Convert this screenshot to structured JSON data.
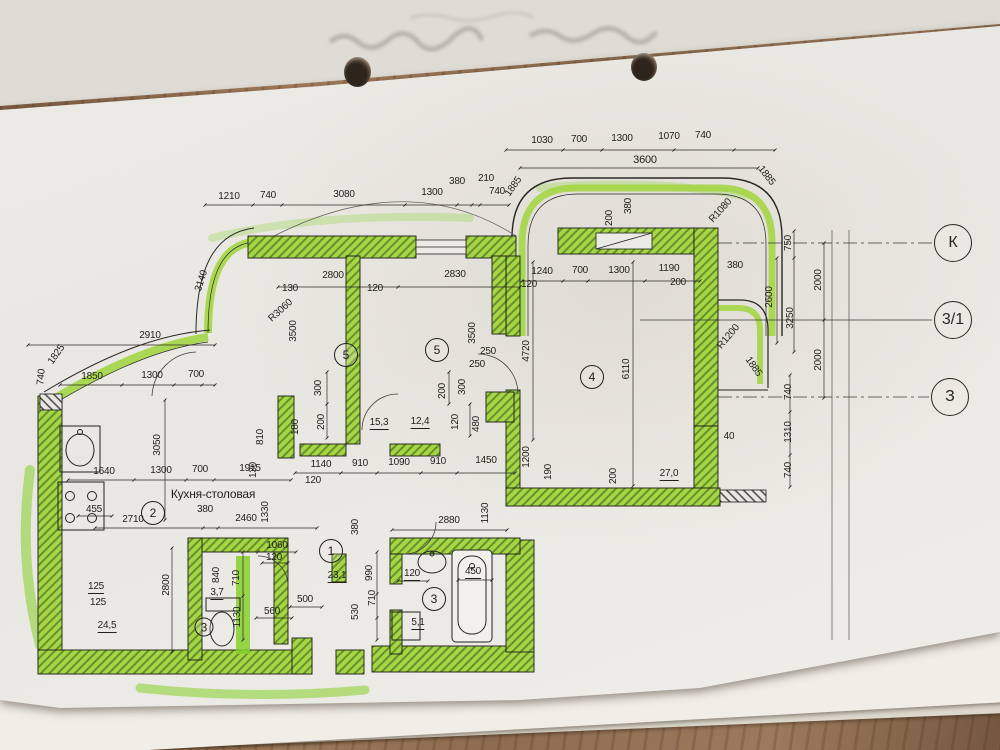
{
  "drawing": {
    "kind": "apartment floor plan, photographed sheet",
    "room_label_kitchen": "Кухня-столовая"
  },
  "colors": {
    "wall_highlight": "#a4d645",
    "marker_green": "#86cf2b",
    "paper": "#eae8e2",
    "ink": "#211f1b",
    "wood": "#8a6a4f"
  },
  "axis_markers": [
    {
      "t": "К",
      "x": 953,
      "y": 243
    },
    {
      "t": "3/1",
      "x": 953,
      "y": 320
    },
    {
      "t": "З",
      "x": 950,
      "y": 397
    }
  ],
  "room_markers": [
    {
      "n": "5",
      "x": 346,
      "y": 355,
      "d": 22
    },
    {
      "n": "5",
      "x": 437,
      "y": 350,
      "d": 22
    },
    {
      "n": "4",
      "x": 592,
      "y": 377,
      "d": 22
    },
    {
      "n": "1",
      "x": 331,
      "y": 551,
      "d": 22
    },
    {
      "n": "2",
      "x": 153,
      "y": 513,
      "d": 22
    },
    {
      "n": "3",
      "x": 434,
      "y": 599,
      "d": 22
    },
    {
      "n": "3",
      "x": 204,
      "y": 627,
      "d": 17
    }
  ],
  "rooms": [
    {
      "number": "5",
      "area": "15,3"
    },
    {
      "number": "5",
      "area": "12,4"
    },
    {
      "number": "4",
      "area": "27,0"
    },
    {
      "number": "1",
      "area": "23,1"
    },
    {
      "number": "2",
      "name": "Кухня-столовая",
      "area": "24,5"
    },
    {
      "number": "3",
      "area": "5,1"
    },
    {
      "number": "3",
      "area": "3,7"
    }
  ],
  "dimension_labels": [
    {
      "t": "1030",
      "x": 542,
      "y": 141
    },
    {
      "t": "700",
      "x": 579,
      "y": 140
    },
    {
      "t": "1300",
      "x": 622,
      "y": 139
    },
    {
      "t": "1070",
      "x": 669,
      "y": 137
    },
    {
      "t": "740",
      "x": 703,
      "y": 136
    },
    {
      "t": "3600",
      "x": 645,
      "y": 160,
      "s": 11
    },
    {
      "t": "1885",
      "x": 514,
      "y": 187,
      "r": -55
    },
    {
      "t": "1885",
      "x": 766,
      "y": 176,
      "r": 52
    },
    {
      "t": "R1080",
      "x": 721,
      "y": 211,
      "r": -48
    },
    {
      "t": "200",
      "x": 610,
      "y": 218,
      "r": -90
    },
    {
      "t": "380",
      "x": 629,
      "y": 206,
      "r": -90
    },
    {
      "t": "1210",
      "x": 229,
      "y": 197
    },
    {
      "t": "740",
      "x": 268,
      "y": 196
    },
    {
      "t": "3080",
      "x": 344,
      "y": 195
    },
    {
      "t": "1300",
      "x": 432,
      "y": 193
    },
    {
      "t": "380",
      "x": 457,
      "y": 182
    },
    {
      "t": "210",
      "x": 486,
      "y": 179
    },
    {
      "t": "740",
      "x": 497,
      "y": 192
    },
    {
      "t": "3140",
      "x": 202,
      "y": 281,
      "r": -72
    },
    {
      "t": "2800",
      "x": 333,
      "y": 276
    },
    {
      "t": "130",
      "x": 290,
      "y": 289
    },
    {
      "t": "120",
      "x": 375,
      "y": 289
    },
    {
      "t": "2830",
      "x": 455,
      "y": 275
    },
    {
      "t": "1240",
      "x": 542,
      "y": 272
    },
    {
      "t": "700",
      "x": 580,
      "y": 271
    },
    {
      "t": "1300",
      "x": 619,
      "y": 271
    },
    {
      "t": "1190",
      "x": 669,
      "y": 269
    },
    {
      "t": "120",
      "x": 529,
      "y": 285
    },
    {
      "t": "200",
      "x": 678,
      "y": 283
    },
    {
      "t": "380",
      "x": 735,
      "y": 266
    },
    {
      "t": "2600",
      "x": 770,
      "y": 297,
      "r": -90
    },
    {
      "t": "750",
      "x": 789,
      "y": 243,
      "r": -90
    },
    {
      "t": "3250",
      "x": 791,
      "y": 318,
      "r": -90
    },
    {
      "t": "2000",
      "x": 819,
      "y": 280,
      "r": -90
    },
    {
      "t": "2000",
      "x": 819,
      "y": 360,
      "r": -90
    },
    {
      "t": "740",
      "x": 789,
      "y": 392,
      "r": -90
    },
    {
      "t": "1310",
      "x": 789,
      "y": 432,
      "r": -90
    },
    {
      "t": "740",
      "x": 789,
      "y": 470,
      "r": -90
    },
    {
      "t": "40",
      "x": 729,
      "y": 437
    },
    {
      "t": "R1200",
      "x": 729,
      "y": 337,
      "r": -50
    },
    {
      "t": "1885",
      "x": 753,
      "y": 367,
      "r": 55
    },
    {
      "t": "2910",
      "x": 150,
      "y": 336
    },
    {
      "t": "1825",
      "x": 57,
      "y": 355,
      "r": -55
    },
    {
      "t": "740",
      "x": 42,
      "y": 377,
      "r": -85
    },
    {
      "t": "1850",
      "x": 92,
      "y": 377
    },
    {
      "t": "1300",
      "x": 152,
      "y": 376
    },
    {
      "t": "700",
      "x": 196,
      "y": 375
    },
    {
      "t": "R3060",
      "x": 281,
      "y": 311,
      "r": -42
    },
    {
      "t": "3500",
      "x": 294,
      "y": 331,
      "r": -90
    },
    {
      "t": "3500",
      "x": 473,
      "y": 333,
      "r": -90
    },
    {
      "t": "300",
      "x": 319,
      "y": 388,
      "r": -90
    },
    {
      "t": "200",
      "x": 322,
      "y": 422,
      "r": -90
    },
    {
      "t": "200",
      "x": 443,
      "y": 391,
      "r": -90
    },
    {
      "t": "300",
      "x": 463,
      "y": 387,
      "r": -90
    },
    {
      "t": "250",
      "x": 488,
      "y": 352
    },
    {
      "t": "250",
      "x": 477,
      "y": 365
    },
    {
      "t": "120",
      "x": 456,
      "y": 422,
      "r": -90
    },
    {
      "t": "480",
      "x": 477,
      "y": 424,
      "r": -90
    },
    {
      "t": "180",
      "x": 296,
      "y": 427,
      "r": -90
    },
    {
      "t": "15,3",
      "x": 379,
      "y": 424,
      "u": true
    },
    {
      "t": "12,4",
      "x": 420,
      "y": 423,
      "u": true
    },
    {
      "t": "4720",
      "x": 527,
      "y": 351,
      "r": -90
    },
    {
      "t": "6110",
      "x": 627,
      "y": 369,
      "r": -90
    },
    {
      "t": "27,0",
      "x": 669,
      "y": 475,
      "u": true
    },
    {
      "t": "200",
      "x": 614,
      "y": 476,
      "r": -90
    },
    {
      "t": "190",
      "x": 549,
      "y": 472,
      "r": -90
    },
    {
      "t": "1200",
      "x": 527,
      "y": 457,
      "r": -90
    },
    {
      "t": "3050",
      "x": 158,
      "y": 445,
      "r": -90
    },
    {
      "t": "1640",
      "x": 104,
      "y": 472
    },
    {
      "t": "1300",
      "x": 161,
      "y": 471
    },
    {
      "t": "700",
      "x": 200,
      "y": 470
    },
    {
      "t": "1915",
      "x": 250,
      "y": 469
    },
    {
      "t": "810",
      "x": 261,
      "y": 437,
      "r": -90
    },
    {
      "t": "130",
      "x": 254,
      "y": 470,
      "r": -90
    },
    {
      "t": "1330",
      "x": 266,
      "y": 512,
      "r": -90
    },
    {
      "t": "Кухня-столовая",
      "x": 213,
      "y": 494,
      "s": 12
    },
    {
      "t": "455",
      "x": 94,
      "y": 510
    },
    {
      "t": "2710",
      "x": 133,
      "y": 520
    },
    {
      "t": "380",
      "x": 205,
      "y": 510
    },
    {
      "t": "2460",
      "x": 246,
      "y": 519
    },
    {
      "t": "1140",
      "x": 321,
      "y": 465
    },
    {
      "t": "910",
      "x": 360,
      "y": 464
    },
    {
      "t": "1090",
      "x": 399,
      "y": 463
    },
    {
      "t": "910",
      "x": 438,
      "y": 462
    },
    {
      "t": "1450",
      "x": 486,
      "y": 461
    },
    {
      "t": "120",
      "x": 313,
      "y": 481
    },
    {
      "t": "1060",
      "x": 277,
      "y": 546
    },
    {
      "t": "120",
      "x": 274,
      "y": 558
    },
    {
      "t": "2880",
      "x": 449,
      "y": 521
    },
    {
      "t": "1130",
      "x": 486,
      "y": 513,
      "r": -90
    },
    {
      "t": "380",
      "x": 356,
      "y": 527,
      "r": -90
    },
    {
      "t": "125",
      "x": 96,
      "y": 588,
      "u": true
    },
    {
      "t": "125",
      "x": 98,
      "y": 603
    },
    {
      "t": "24,5",
      "x": 107,
      "y": 627,
      "u": true
    },
    {
      "t": "2800",
      "x": 167,
      "y": 585,
      "r": -90
    },
    {
      "t": "840",
      "x": 217,
      "y": 575,
      "r": -90
    },
    {
      "t": "710",
      "x": 237,
      "y": 578,
      "r": -90
    },
    {
      "t": "3,7",
      "x": 217,
      "y": 594,
      "u": true
    },
    {
      "t": "500",
      "x": 305,
      "y": 600
    },
    {
      "t": "560",
      "x": 272,
      "y": 612
    },
    {
      "t": "1130",
      "x": 238,
      "y": 617,
      "r": -90
    },
    {
      "t": "23,1",
      "x": 337,
      "y": 577,
      "u": true
    },
    {
      "t": "990",
      "x": 370,
      "y": 573,
      "r": -90
    },
    {
      "t": "710",
      "x": 373,
      "y": 598,
      "r": -90
    },
    {
      "t": "530",
      "x": 356,
      "y": 612,
      "r": -90
    },
    {
      "t": "5,1",
      "x": 418,
      "y": 624,
      "u": true
    },
    {
      "t": "120",
      "x": 412,
      "y": 575,
      "u": true
    },
    {
      "t": "450",
      "x": 473,
      "y": 573,
      "u": true
    }
  ]
}
